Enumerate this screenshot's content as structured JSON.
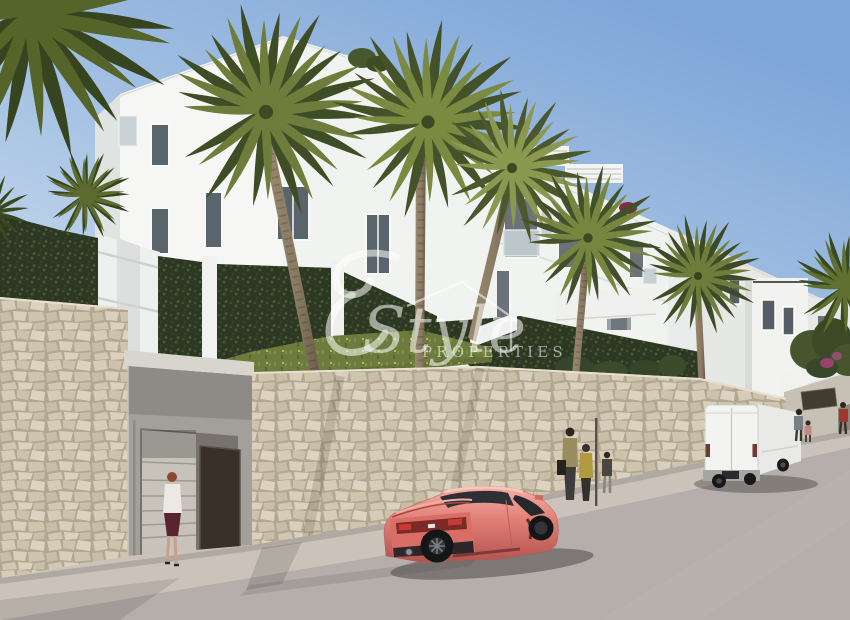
{
  "watermark": {
    "initial": "E",
    "brand_script": "Style",
    "brand_caps": "PROPERTIES",
    "color": "#ffffff"
  },
  "scene": {
    "description": "3D architectural render of a white Mediterranean apartment complex on a hillside with palm trees, stone retaining walls, pedestrians, a coral sports coupe and a white van parked on the street",
    "colors": {
      "sky_top": "#7ea6d8",
      "sky_bottom": "#cadbee",
      "building_sunlit": "#f6f7f5",
      "building_shaded": "#dfe3e2",
      "stone_mortar": "#b2a791",
      "grass": "#6d7c3e",
      "hedge": "#2c3823",
      "road": "#b5aeab",
      "sidewalk": "#cbc3ba",
      "car_body": "#e07e76",
      "car_highlight": "#f6b0a5",
      "car_dark": "#b4544f",
      "van_body": "#f3f3f1",
      "door": "#3a3028"
    }
  }
}
